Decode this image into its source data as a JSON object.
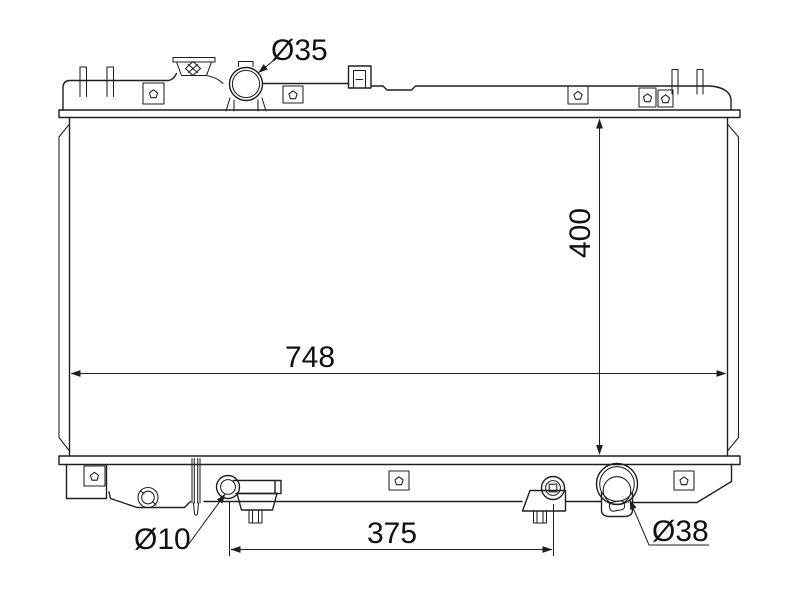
{
  "diagram": {
    "labels": {
      "filler_neck_diameter": "Ø35",
      "core_height": "400",
      "core_width": "748",
      "drain_pipe_diameter": "Ø10",
      "mount_spacing": "375",
      "outlet_diameter": "Ø38"
    },
    "colors": {
      "line": "#1f1f1f",
      "background": "#ffffff"
    }
  }
}
